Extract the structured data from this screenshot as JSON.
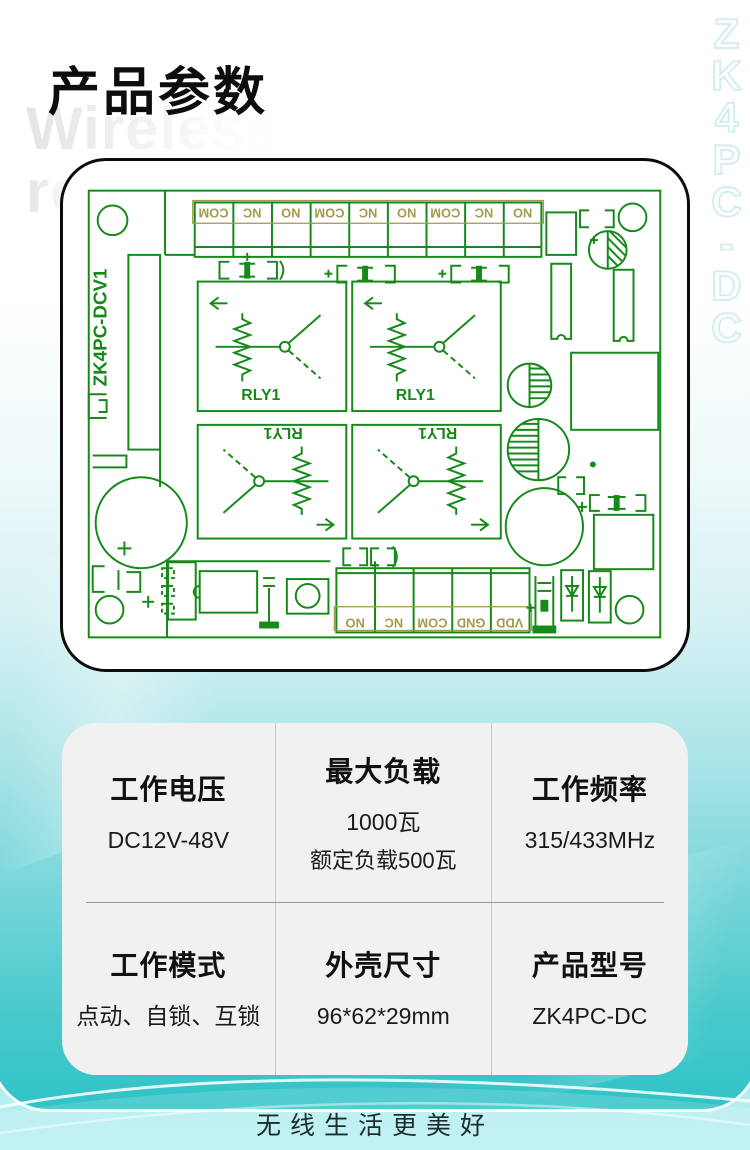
{
  "header": {
    "title": "产品参数",
    "watermark_line1": "Wireless",
    "watermark_line2": "re",
    "side_model": "ZK4PC-DC"
  },
  "pcb": {
    "board_model": "ZK4PC-DCV1",
    "relay_label": "RLY1",
    "top_terminal_labels": [
      "COM",
      "NC",
      "NO",
      "COM",
      "NC",
      "NO",
      "COM",
      "NC",
      "NO"
    ],
    "bottom_terminal_labels": [
      "NO",
      "NC",
      "COM",
      "GND",
      "VDD"
    ]
  },
  "specs": {
    "cells": [
      {
        "label": "工作电压",
        "value": "DC12V-48V"
      },
      {
        "label": "最大负载",
        "value": "1000瓦",
        "value2": "额定负载500瓦"
      },
      {
        "label": "工作频率",
        "value": "315/433MHz"
      },
      {
        "label": "工作模式",
        "value": "点动、自锁、互锁"
      },
      {
        "label": "外壳尺寸",
        "value": "96*62*29mm"
      },
      {
        "label": "产品型号",
        "value": "ZK4PC-DC"
      }
    ]
  },
  "footer": {
    "slogan": "无线生活更美好"
  },
  "colors": {
    "pcb_green": "#17891b",
    "pcb_label_olive": "#a49a4e",
    "teal_deep": "#2fc3c6",
    "card_gray": "#f2f1f1",
    "border_black": "#0c0c0c"
  }
}
